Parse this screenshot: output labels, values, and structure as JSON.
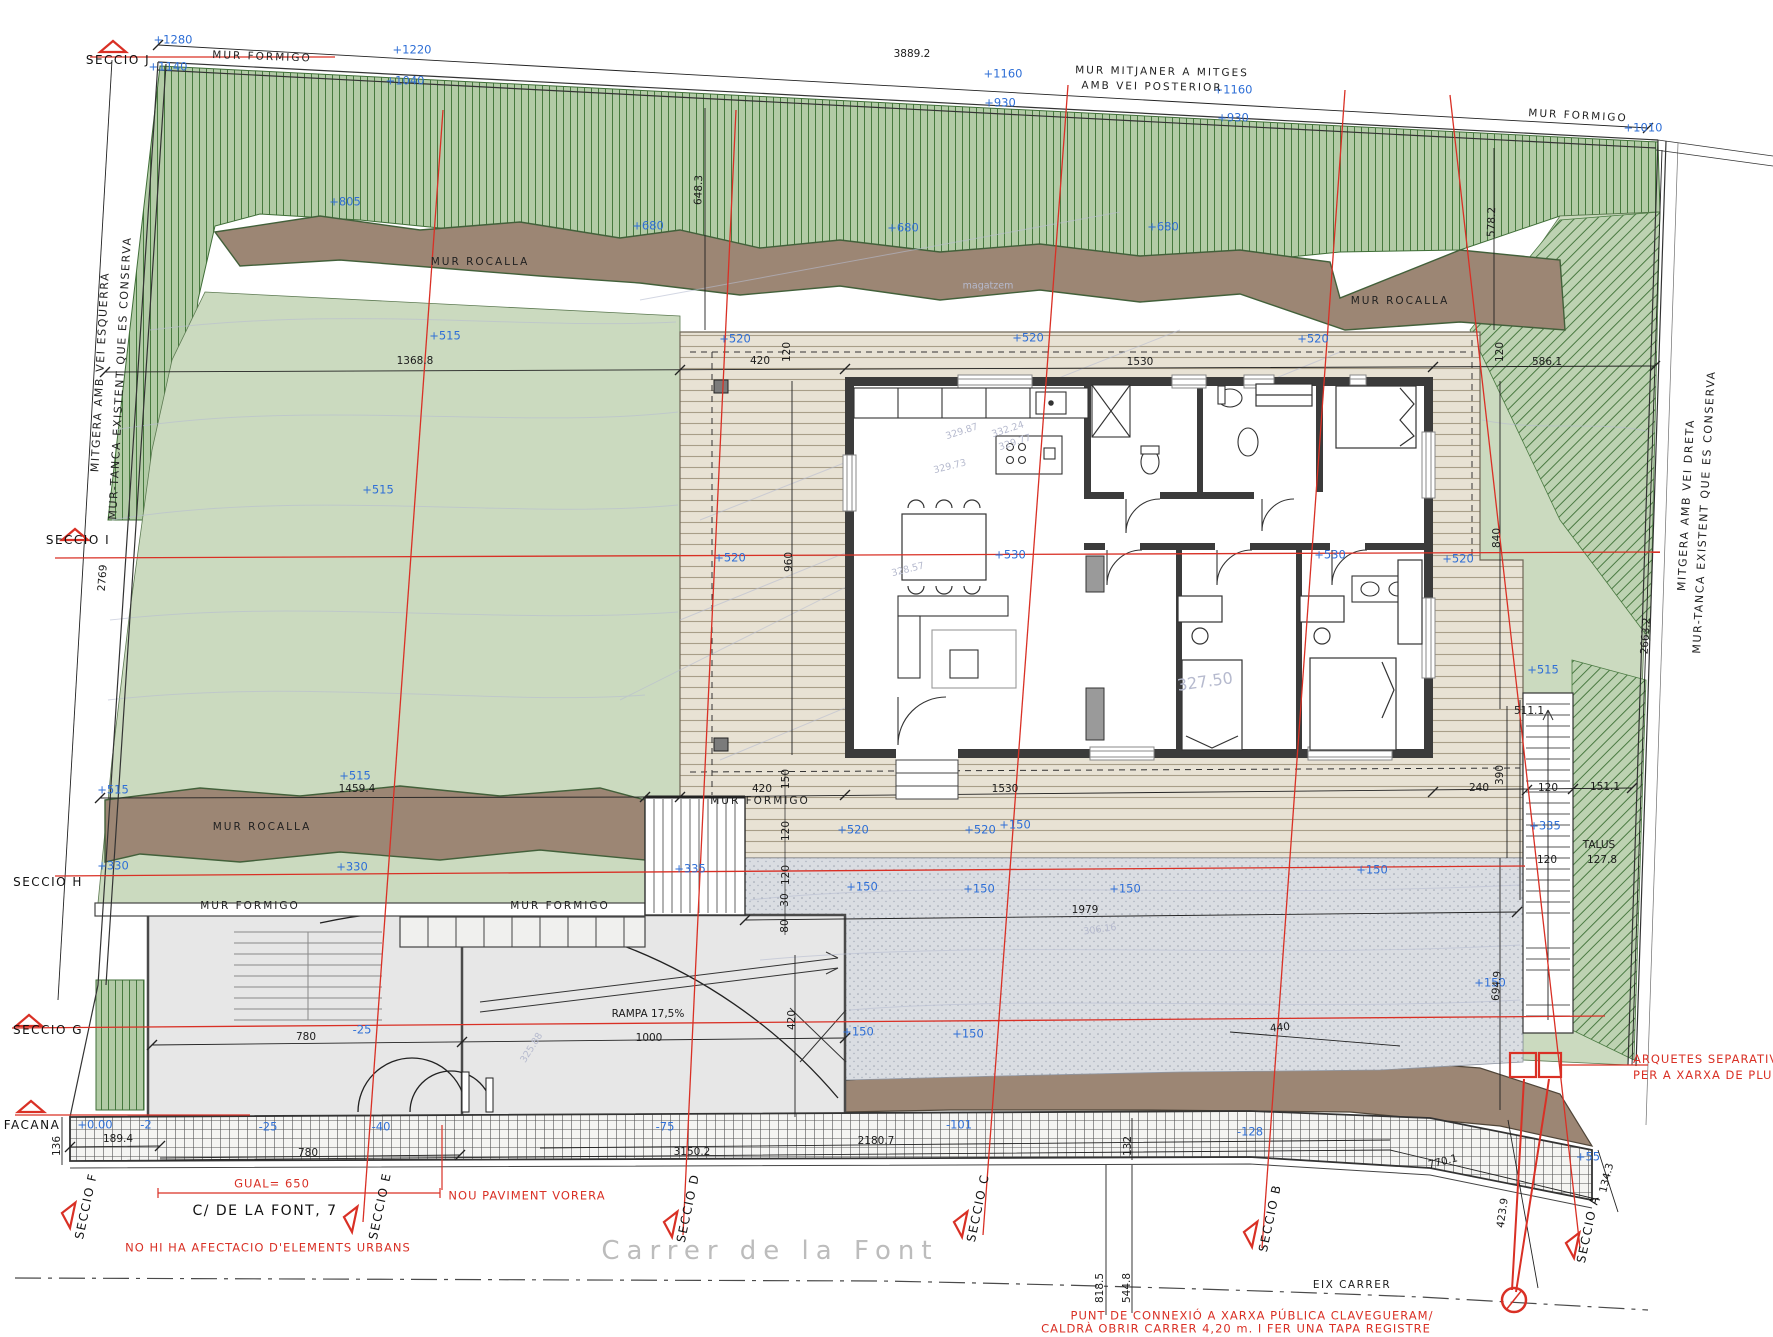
{
  "street": {
    "name": "Carrer  de  la  Font",
    "address": "C/  DE  LA  FONT,  7",
    "axis": "EIX  CARRER"
  },
  "notes": {
    "gual": "GUAL=  650",
    "paviment": "NOU  PAVIMENT  VORERA",
    "urbans": "NO  HI  HA  AFECTACIO  D'ELEMENTS  URBANS",
    "arquetes1": "ARQUETES  SEPARATIVES",
    "arquetes2": "PER  A  XARXA  DE  PLU",
    "connexio1": "PUNT  DE  CONNEXIÓ  A  XARXA  PÚBLICA  CLAVEGUERAM/",
    "connexio2": "CALDRÀ  OBRIR  CARRER  4,20  m.  I  FER  UNA  TAPA  REGISTRE"
  },
  "colors": {
    "section_red": "#d93025",
    "elevation_blue": "#2f6fd6",
    "slope_hatch_green": "#b2cba6",
    "lawn_green": "#cbdabf",
    "rocalla_brown": "#9c8674",
    "deck_beige": "#e8e2d4",
    "gravel_gray": "#dadde2",
    "paving_gray": "#e7e7e7"
  },
  "labels": [
    {
      "t": "+1280",
      "x": 173,
      "y": 40,
      "c": "e"
    },
    {
      "t": "+1140",
      "x": 168,
      "y": 67,
      "c": "e"
    },
    {
      "t": "+1220",
      "x": 412,
      "y": 50,
      "c": "e"
    },
    {
      "t": "+1040",
      "x": 405,
      "y": 81,
      "c": "e"
    },
    {
      "t": "+1160",
      "x": 1003,
      "y": 74,
      "c": "e"
    },
    {
      "t": "+930",
      "x": 1000,
      "y": 103,
      "c": "e"
    },
    {
      "t": "+1160",
      "x": 1233,
      "y": 90,
      "c": "e"
    },
    {
      "t": "+930",
      "x": 1233,
      "y": 118,
      "c": "e"
    },
    {
      "t": "+1010",
      "x": 1643,
      "y": 128,
      "c": "e"
    },
    {
      "t": "+805",
      "x": 345,
      "y": 202,
      "c": "e"
    },
    {
      "t": "+680",
      "x": 648,
      "y": 226,
      "c": "e"
    },
    {
      "t": "+680",
      "x": 903,
      "y": 228,
      "c": "e"
    },
    {
      "t": "+680",
      "x": 1163,
      "y": 227,
      "c": "e"
    },
    {
      "t": "+515",
      "x": 445,
      "y": 336,
      "c": "e"
    },
    {
      "t": "+515",
      "x": 378,
      "y": 490,
      "c": "e"
    },
    {
      "t": "+515",
      "x": 355,
      "y": 776,
      "c": "e"
    },
    {
      "t": "+515",
      "x": 113,
      "y": 790,
      "c": "e"
    },
    {
      "t": "+515",
      "x": 1543,
      "y": 670,
      "c": "e"
    },
    {
      "t": "+520",
      "x": 735,
      "y": 339,
      "c": "e"
    },
    {
      "t": "+520",
      "x": 1028,
      "y": 338,
      "c": "e"
    },
    {
      "t": "+520",
      "x": 1313,
      "y": 339,
      "c": "e"
    },
    {
      "t": "+520",
      "x": 730,
      "y": 558,
      "c": "e"
    },
    {
      "t": "+520",
      "x": 1458,
      "y": 559,
      "c": "e"
    },
    {
      "t": "+520",
      "x": 853,
      "y": 830,
      "c": "e"
    },
    {
      "t": "+520",
      "x": 980,
      "y": 830,
      "c": "e"
    },
    {
      "t": "+530",
      "x": 1010,
      "y": 555,
      "c": "e"
    },
    {
      "t": "+530",
      "x": 1330,
      "y": 555,
      "c": "e"
    },
    {
      "t": "+330",
      "x": 113,
      "y": 866,
      "c": "e"
    },
    {
      "t": "+330",
      "x": 352,
      "y": 867,
      "c": "e"
    },
    {
      "t": "+335",
      "x": 690,
      "y": 869,
      "c": "e"
    },
    {
      "t": "+335",
      "x": 1545,
      "y": 826,
      "c": "e"
    },
    {
      "t": "+150",
      "x": 1015,
      "y": 825,
      "c": "e"
    },
    {
      "t": "+150",
      "x": 862,
      "y": 887,
      "c": "e"
    },
    {
      "t": "+150",
      "x": 979,
      "y": 889,
      "c": "e"
    },
    {
      "t": "+150",
      "x": 1125,
      "y": 889,
      "c": "e"
    },
    {
      "t": "+150",
      "x": 1372,
      "y": 870,
      "c": "e"
    },
    {
      "t": "+150",
      "x": 858,
      "y": 1032,
      "c": "e"
    },
    {
      "t": "+150",
      "x": 968,
      "y": 1034,
      "c": "e"
    },
    {
      "t": "+150",
      "x": 1490,
      "y": 983,
      "c": "e"
    },
    {
      "t": "-25",
      "x": 362,
      "y": 1030,
      "c": "e"
    },
    {
      "t": "+0.00",
      "x": 95,
      "y": 1125,
      "c": "e"
    },
    {
      "t": "-2",
      "x": 146,
      "y": 1125,
      "c": "e"
    },
    {
      "t": "-25",
      "x": 268,
      "y": 1127,
      "c": "e"
    },
    {
      "t": "-40",
      "x": 381,
      "y": 1127,
      "c": "e"
    },
    {
      "t": "-75",
      "x": 665,
      "y": 1127,
      "c": "e"
    },
    {
      "t": "-101",
      "x": 959,
      "y": 1125,
      "c": "e"
    },
    {
      "t": "-128",
      "x": 1250,
      "y": 1132,
      "c": "e"
    },
    {
      "t": "+55",
      "x": 1588,
      "y": 1157,
      "c": "e"
    },
    {
      "t": "3889.2",
      "x": 912,
      "y": 54,
      "c": "d"
    },
    {
      "t": "2769",
      "x": 103,
      "y": 578,
      "c": "d",
      "r": -86
    },
    {
      "t": "648.3",
      "x": 699,
      "y": 190,
      "c": "d",
      "r": -88
    },
    {
      "t": "578.2",
      "x": 1492,
      "y": 222,
      "c": "d",
      "r": -88
    },
    {
      "t": "1368.8",
      "x": 415,
      "y": 361,
      "c": "d"
    },
    {
      "t": "420",
      "x": 760,
      "y": 361,
      "c": "d"
    },
    {
      "t": "120",
      "x": 787,
      "y": 352,
      "c": "d",
      "r": -90
    },
    {
      "t": "1530",
      "x": 1140,
      "y": 362,
      "c": "d"
    },
    {
      "t": "586.1",
      "x": 1547,
      "y": 362,
      "c": "d"
    },
    {
      "t": "120",
      "x": 1500,
      "y": 352,
      "c": "d",
      "r": -90
    },
    {
      "t": "960",
      "x": 789,
      "y": 562,
      "c": "d",
      "r": -90
    },
    {
      "t": "840",
      "x": 1497,
      "y": 538,
      "c": "d",
      "r": -90
    },
    {
      "t": "2663.2",
      "x": 1646,
      "y": 636,
      "c": "d",
      "r": -86
    },
    {
      "t": "1459.4",
      "x": 357,
      "y": 789,
      "c": "d"
    },
    {
      "t": "420",
      "x": 762,
      "y": 789,
      "c": "d"
    },
    {
      "t": "1530",
      "x": 1005,
      "y": 789,
      "c": "d"
    },
    {
      "t": "240",
      "x": 1479,
      "y": 788,
      "c": "d"
    },
    {
      "t": "390",
      "x": 1500,
      "y": 775,
      "c": "d",
      "r": -90
    },
    {
      "t": "120",
      "x": 1548,
      "y": 788,
      "c": "d"
    },
    {
      "t": "151.1",
      "x": 1605,
      "y": 787,
      "c": "d"
    },
    {
      "t": "511.1",
      "x": 1529,
      "y": 711,
      "c": "d"
    },
    {
      "t": "120",
      "x": 1547,
      "y": 860,
      "c": "d"
    },
    {
      "t": "TALUS",
      "x": 1599,
      "y": 845,
      "c": "d"
    },
    {
      "t": "127.8",
      "x": 1602,
      "y": 860,
      "c": "d"
    },
    {
      "t": "150",
      "x": 786,
      "y": 779,
      "c": "d",
      "r": -90
    },
    {
      "t": "120",
      "x": 786,
      "y": 831,
      "c": "d",
      "r": -90
    },
    {
      "t": "120",
      "x": 786,
      "y": 875,
      "c": "d",
      "r": -90
    },
    {
      "t": "30",
      "x": 785,
      "y": 900,
      "c": "d",
      "r": -90
    },
    {
      "t": "80",
      "x": 785,
      "y": 926,
      "c": "d",
      "r": -90
    },
    {
      "t": "1979",
      "x": 1085,
      "y": 910,
      "c": "d"
    },
    {
      "t": "694.9",
      "x": 1497,
      "y": 986,
      "c": "d",
      "r": -86
    },
    {
      "t": "420",
      "x": 792,
      "y": 1020,
      "c": "d",
      "r": -90
    },
    {
      "t": "780",
      "x": 306,
      "y": 1037,
      "c": "d"
    },
    {
      "t": "1000",
      "x": 649,
      "y": 1038,
      "c": "d"
    },
    {
      "t": "RAMPA  17,5%",
      "x": 648,
      "y": 1014,
      "c": "d"
    },
    {
      "t": "136",
      "x": 57,
      "y": 1146,
      "c": "d",
      "r": -90
    },
    {
      "t": "189.4",
      "x": 118,
      "y": 1139,
      "c": "d"
    },
    {
      "t": "780",
      "x": 308,
      "y": 1153,
      "c": "d"
    },
    {
      "t": "3150.2",
      "x": 692,
      "y": 1152,
      "c": "d"
    },
    {
      "t": "2180.7",
      "x": 876,
      "y": 1141,
      "c": "d"
    },
    {
      "t": "132",
      "x": 1128,
      "y": 1146,
      "c": "d",
      "r": -90
    },
    {
      "t": "440",
      "x": 1280,
      "y": 1028,
      "c": "d",
      "r": -6
    },
    {
      "t": "770.1",
      "x": 1443,
      "y": 1162,
      "c": "d",
      "r": -14
    },
    {
      "t": "423.9",
      "x": 1503,
      "y": 1213,
      "c": "d",
      "r": -82
    },
    {
      "t": "134.3",
      "x": 1607,
      "y": 1178,
      "c": "d",
      "r": -76
    },
    {
      "t": "818.5",
      "x": 1100,
      "y": 1288,
      "c": "d",
      "r": -90
    },
    {
      "t": "544.8",
      "x": 1127,
      "y": 1288,
      "c": "d",
      "r": -90
    },
    {
      "t": "MUR  FORMIGO",
      "x": 262,
      "y": 57,
      "c": "m",
      "r": 2
    },
    {
      "t": "MUR  FORMIGO",
      "x": 1578,
      "y": 116,
      "c": "m",
      "r": 3
    },
    {
      "t": "MUR  MITJANER  A  MITGES",
      "x": 1162,
      "y": 72,
      "c": "m",
      "r": 1
    },
    {
      "t": "AMB  VEI  POSTERIOR",
      "x": 1152,
      "y": 87,
      "c": "m",
      "r": 1
    },
    {
      "t": "MUR  ROCALLA",
      "x": 480,
      "y": 262,
      "c": "m"
    },
    {
      "t": "MUR  ROCALLA",
      "x": 1400,
      "y": 301,
      "c": "m"
    },
    {
      "t": "MUR  ROCALLA",
      "x": 262,
      "y": 827,
      "c": "m"
    },
    {
      "t": "MUR  FORMIGO",
      "x": 250,
      "y": 906,
      "c": "m"
    },
    {
      "t": "MUR  FORMIGO",
      "x": 560,
      "y": 906,
      "c": "m"
    },
    {
      "t": "MUR  FORMIGO",
      "x": 760,
      "y": 801,
      "c": "m"
    },
    {
      "t": "SECCIO  J",
      "x": 118,
      "y": 60,
      "c": "s"
    },
    {
      "t": "SECCIO  I",
      "x": 78,
      "y": 540,
      "c": "s"
    },
    {
      "t": "SECCIO  H",
      "x": 48,
      "y": 882,
      "c": "s"
    },
    {
      "t": "SECCIO  G",
      "x": 48,
      "y": 1030,
      "c": "s"
    },
    {
      "t": "FACANA",
      "x": 32,
      "y": 1125,
      "c": "s"
    },
    {
      "t": "SECCIO  F",
      "x": 86,
      "y": 1206,
      "c": "s",
      "r": -78
    },
    {
      "t": "SECCIO  E",
      "x": 380,
      "y": 1206,
      "c": "s",
      "r": -78
    },
    {
      "t": "SECCIO  D",
      "x": 688,
      "y": 1208,
      "c": "s",
      "r": -78
    },
    {
      "t": "SECCIO  C",
      "x": 978,
      "y": 1208,
      "c": "s",
      "r": -78
    },
    {
      "t": "SECCIO  B",
      "x": 1270,
      "y": 1218,
      "c": "s",
      "r": -78
    },
    {
      "t": "SECCIO  A",
      "x": 1588,
      "y": 1229,
      "c": "s",
      "r": -78
    },
    {
      "t": "magatzem",
      "x": 988,
      "y": 286,
      "c": "g"
    },
    {
      "t": "327.50",
      "x": 1205,
      "y": 682,
      "c": "g",
      "r": -8,
      "s": 16
    },
    {
      "t": "329.87",
      "x": 962,
      "y": 432,
      "c": "g",
      "r": -18
    },
    {
      "t": "332.24",
      "x": 1008,
      "y": 430,
      "c": "g",
      "r": -18
    },
    {
      "t": "329.77",
      "x": 1015,
      "y": 443,
      "c": "g",
      "r": -18
    },
    {
      "t": "329.73",
      "x": 950,
      "y": 467,
      "c": "g",
      "r": -14
    },
    {
      "t": "328.57",
      "x": 908,
      "y": 570,
      "c": "g",
      "r": -14
    },
    {
      "t": "325.88",
      "x": 532,
      "y": 1048,
      "c": "g",
      "r": -58
    },
    {
      "t": "306.16",
      "x": 1100,
      "y": 930,
      "c": "g",
      "r": -8
    },
    {
      "t": "MITGERA  AMB  VEI  ESQUERRA",
      "x": 100,
      "y": 372,
      "c": "v",
      "r": -87
    },
    {
      "t": "MUR-TANCA  EXISTENT  QUE  ES  CONSERVA",
      "x": 120,
      "y": 378,
      "c": "v",
      "r": -87
    },
    {
      "t": "MITGERA  AMB  VEI  DRETA",
      "x": 1686,
      "y": 505,
      "c": "v",
      "r": -87
    },
    {
      "t": "MUR-TANCA  EXISTENT  QUE  ES  CONSERVA",
      "x": 1704,
      "y": 512,
      "c": "v",
      "r": -87
    }
  ]
}
